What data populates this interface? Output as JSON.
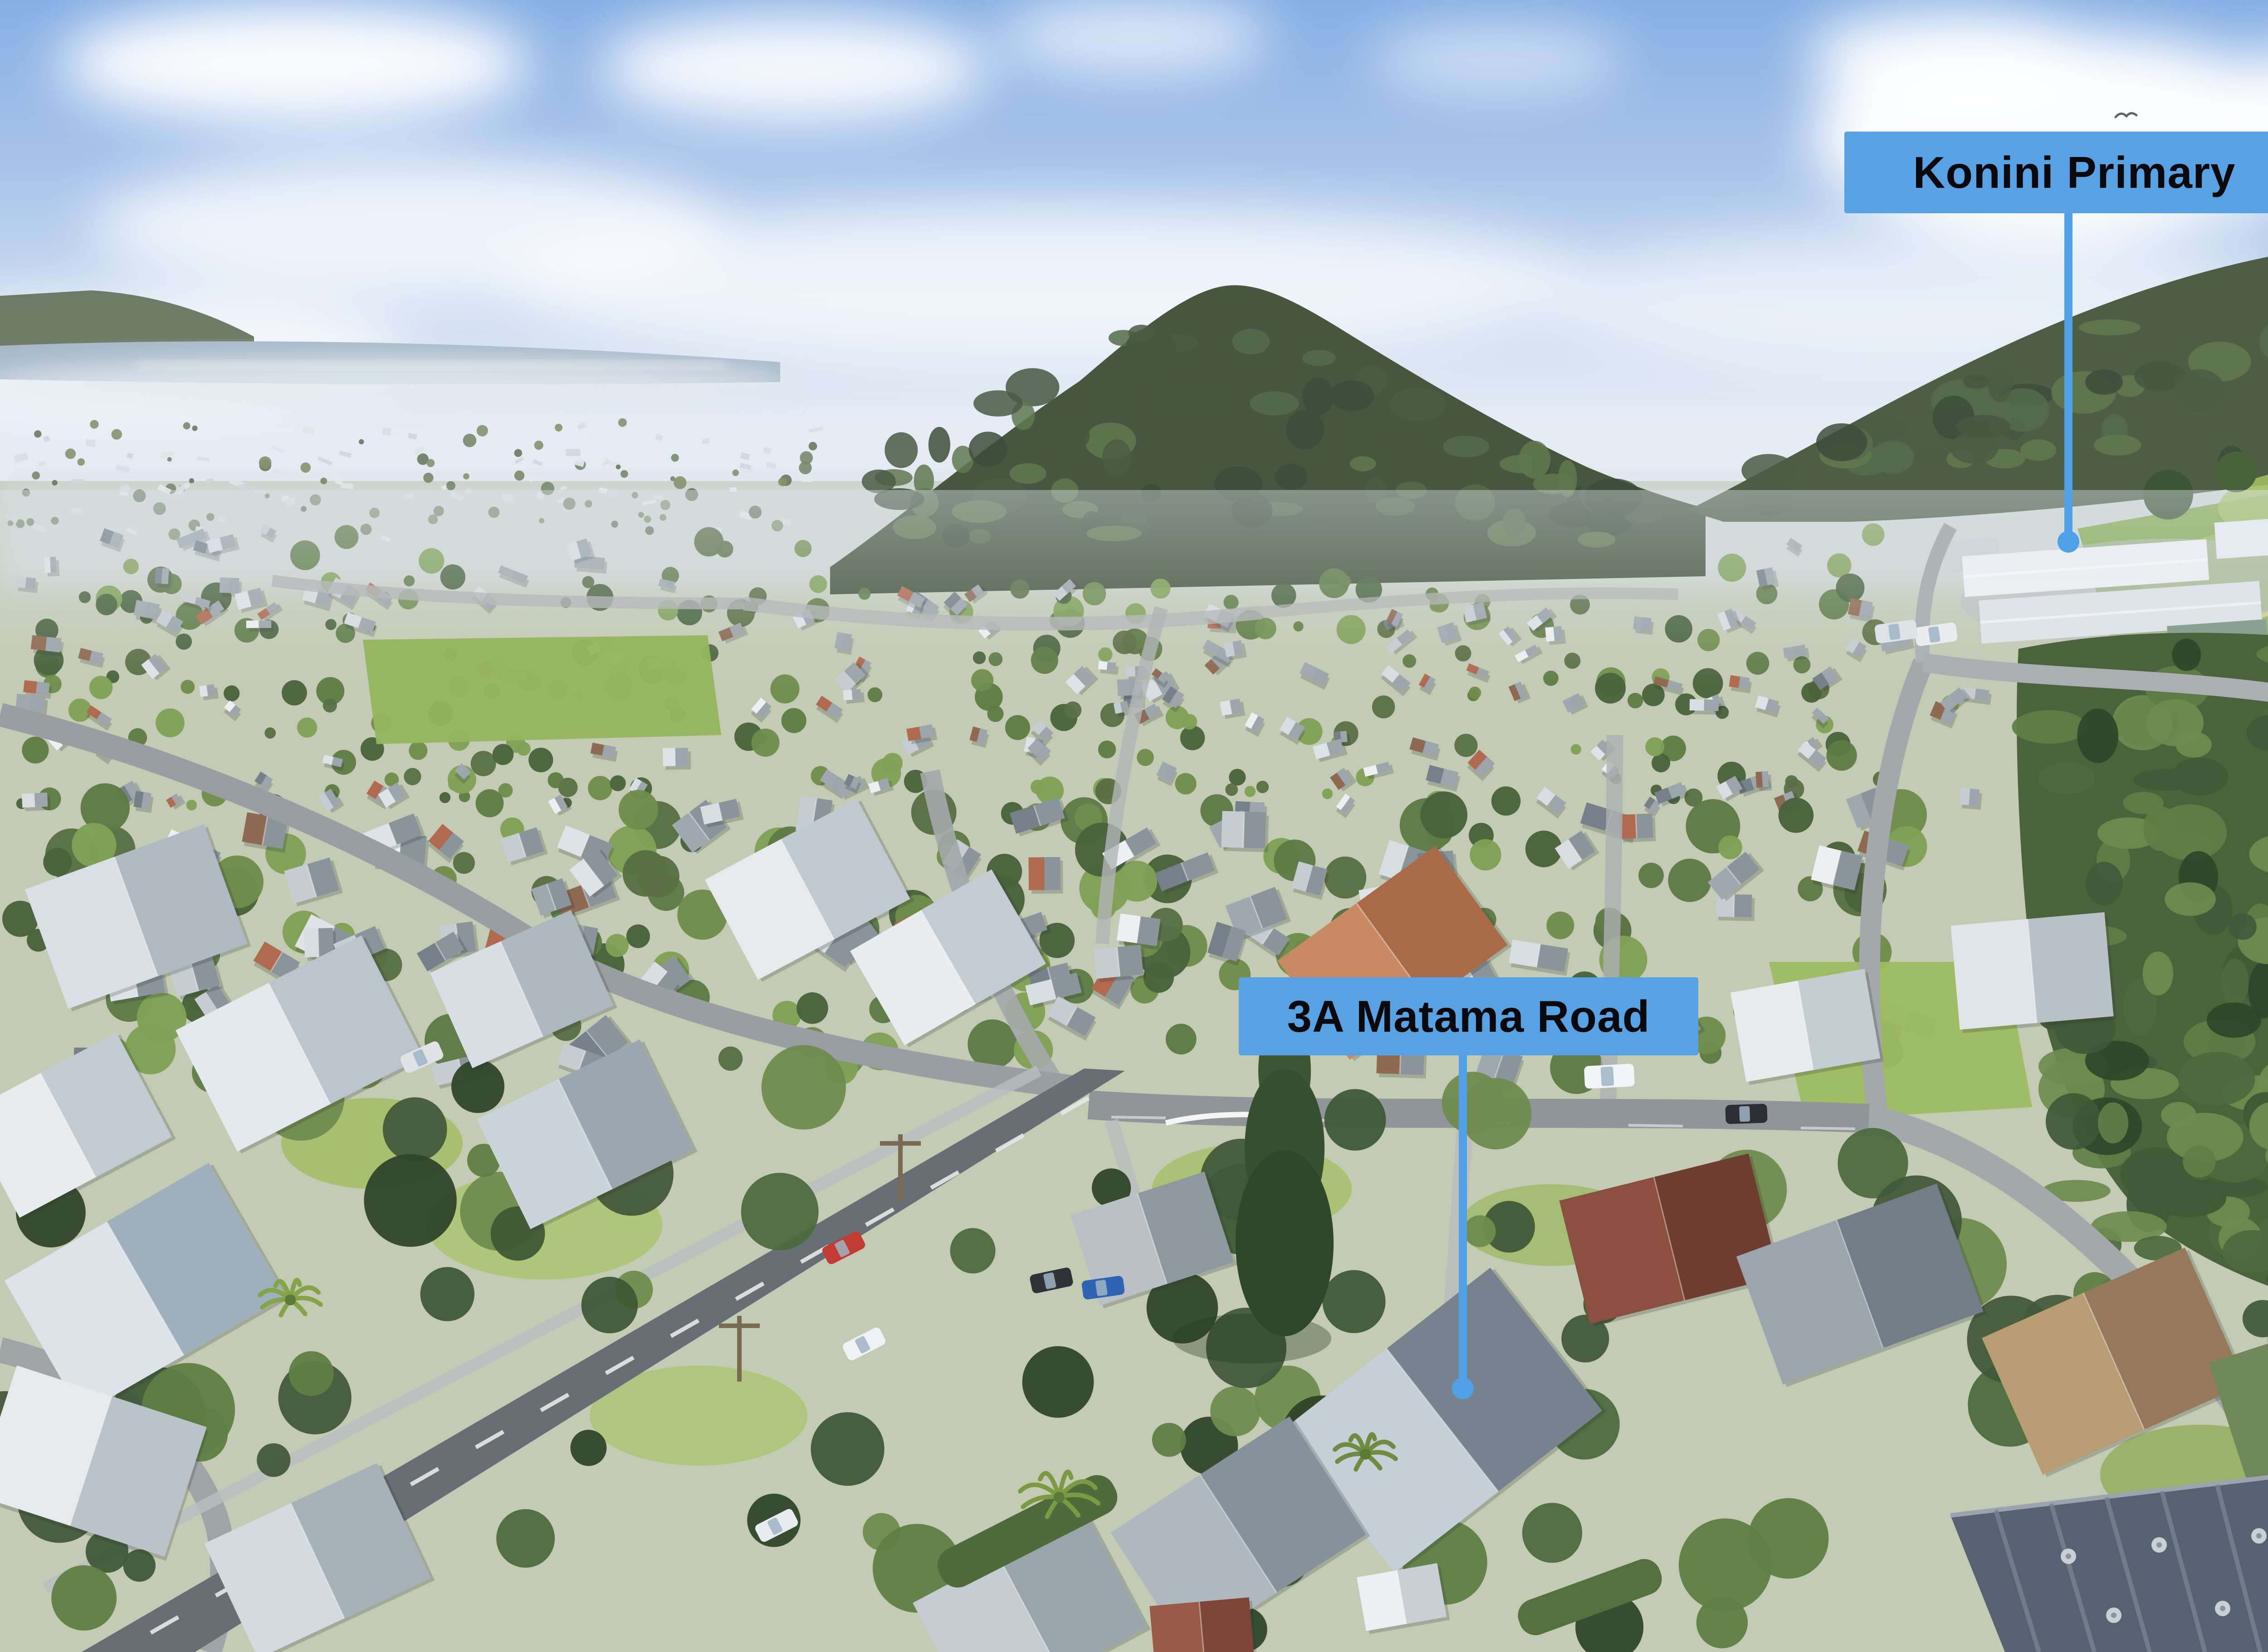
{
  "callouts": [
    {
      "id": "konini-primary",
      "label": "Konini Primary"
    },
    {
      "id": "property-address",
      "label": "3A Matama Road"
    }
  ],
  "colors": {
    "callout_background": "#58A1E3",
    "callout_text": "#0A0A0E",
    "leader_line": "#4FA0E6"
  }
}
